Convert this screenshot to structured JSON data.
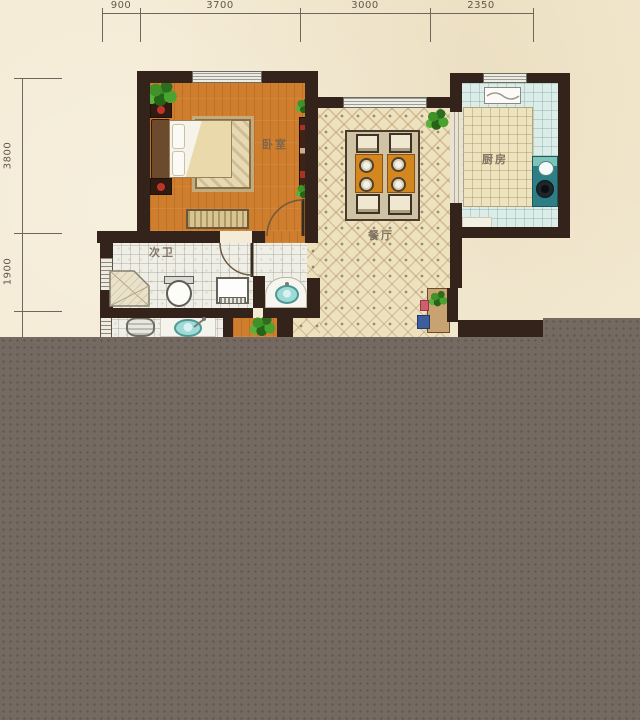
{
  "plan": {
    "type": "apartment-floor-plan",
    "rooms": {
      "bedroom": "卧室",
      "dining": "餐厅",
      "kitchen": "厨房",
      "bath": "次卫"
    },
    "dimensions": {
      "top": [
        "900",
        "3700",
        "3000",
        "2350"
      ],
      "left": [
        "3800",
        "1900"
      ]
    },
    "colors": {
      "background": "#f3e9d0",
      "wall": "#33231a",
      "bedroom_floor": "#cf7e2d",
      "dining_tile": "#eee1be",
      "kitchen_floor": "#dcece8",
      "bath_tile": "#f0efe7",
      "dining_table": "#d4861f",
      "kitchen_counter": "#eee3bf",
      "fixture_teal": "#9edbd7",
      "censor_overlay": "#746a61"
    }
  }
}
